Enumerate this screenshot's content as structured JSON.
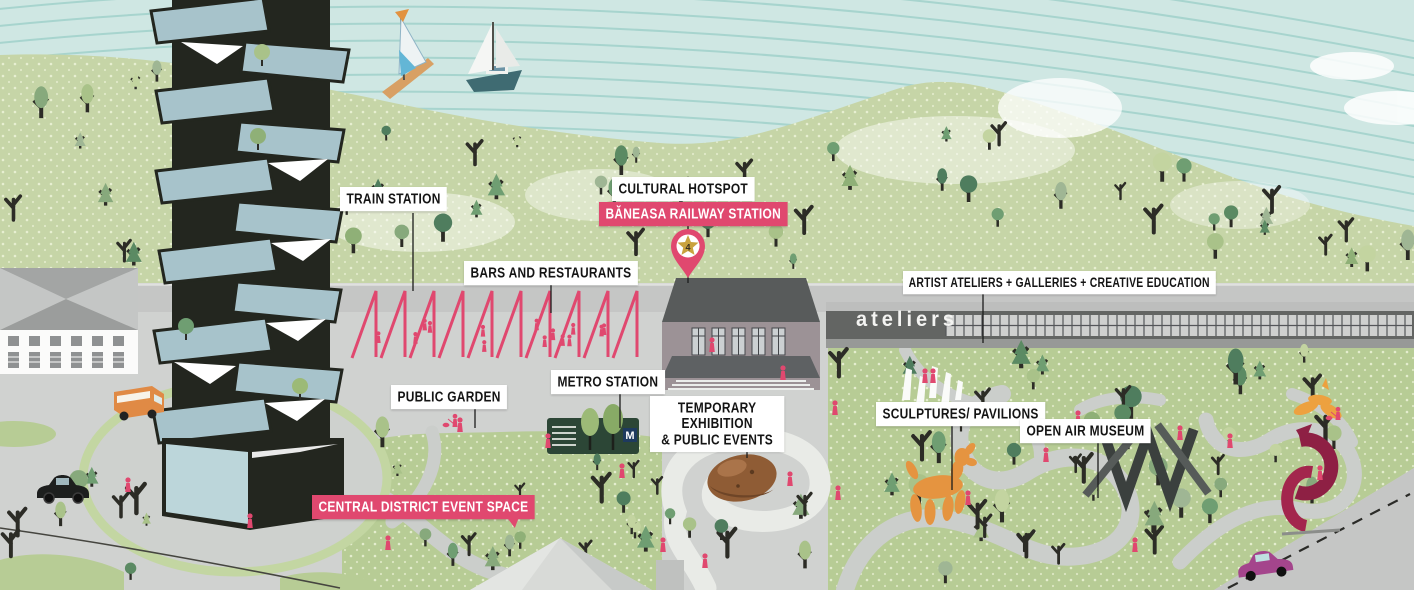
{
  "map": {
    "callouts": {
      "train_station": "TRAIN STATION",
      "cultural_hotspot": "CULTURAL HOTSPOT",
      "baneasa_railway_station": "BĂNEASA RAILWAY STATION",
      "bars_and_restaurants": "BARS AND RESTAURANTS",
      "metro_station": "METRO STATION",
      "public_garden": "PUBLIC GARDEN",
      "temporary_exhibition": "TEMPORARY EXHIBITION",
      "public_events": "& PUBLIC EVENTS",
      "artist_ateliers": "ARTIST ATELIERS + GALLERIES + CREATIVE EDUCATION",
      "sculptures_pavilions": "SCULPTURES/ PAVILIONS",
      "open_air_museum": "OPEN AIR MUSEUM",
      "central_district_event_space": "CENTRAL DISTRICT EVENT SPACE"
    },
    "signs": {
      "ateliers_building": "ateliers",
      "metro_logo": "M"
    },
    "pin": {
      "number": "4"
    },
    "colors": {
      "water": "#cfe7e3",
      "water_stripe": "#9ccfc8",
      "hill_green": "#c6d5a7",
      "park_green": "#b7cc95",
      "pavement": "#d0d2d0",
      "road": "#c5c6c5",
      "accent_pink": "#e0486f",
      "label_bg": "#ffffff",
      "label_text": "#141414",
      "tower_black": "#23261f",
      "tower_glass": "#a7c3cb",
      "sculpture_orange": "#e59440",
      "sculpture_maroon": "#8e2044",
      "station_wall": "#9c9296",
      "station_roof": "#585b5b",
      "ateliers_dark": "#636563",
      "metro_green": "#2c4636"
    }
  }
}
